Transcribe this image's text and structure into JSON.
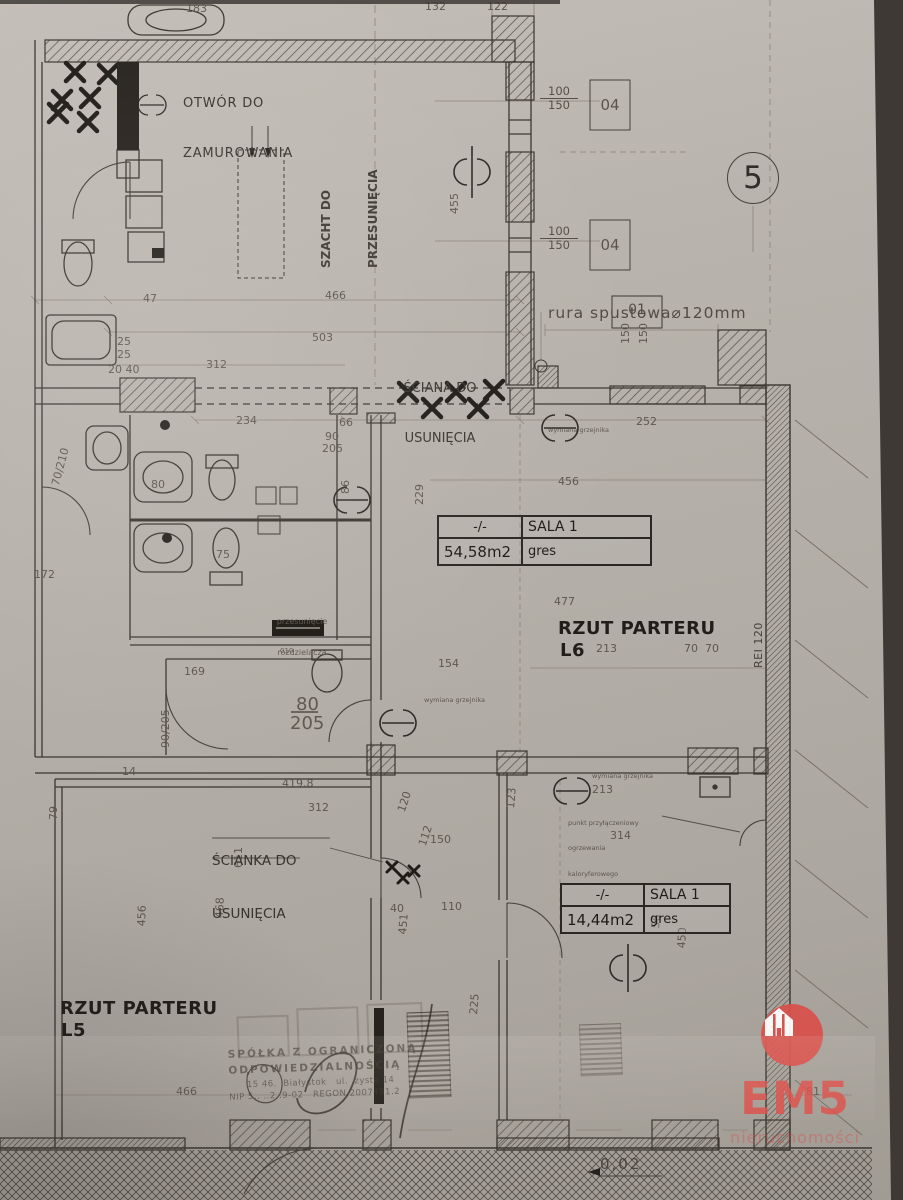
{
  "photo": {
    "backdrop_color": "#3e3935",
    "paper_color": "#b4afa8"
  },
  "plan": {
    "marker_number": "5",
    "titles": {
      "l6_line1": "RZUT PARTERU",
      "l6_line2": "L6",
      "l5_line1": "RZUT PARTERU",
      "l5_line2": "L5"
    },
    "annotations": {
      "otwor_line1": "OTWÓR DO",
      "otwor_line2": "ZAMUROWANIA",
      "szacht_line1": "SZACHT DO",
      "szacht_line2": "PRZESUNIĘCIA",
      "sciana_line1": "ŚCIANA DO",
      "sciana_line2": "USUNIĘCIA",
      "scianka_line1": "ŚCIANKA DO",
      "scianka_line2": "USUNIĘCIA",
      "rura": "rura spustowa⌀120mm",
      "rura_tag": "01",
      "rei": "REI 120",
      "slope": "0,02",
      "przesuniecie_line1": "przesunięcie",
      "przesuniecie_line2": "rozdzielacza",
      "punkt_line1": "punkt przyłączeniowy",
      "punkt_line2": "ogrzewania",
      "punkt_line3": "kaloryferowego",
      "note_grzejnik": "wymiana grzejnika"
    },
    "windows": {
      "w_top": "100",
      "w_bottom": "150",
      "tag": "04"
    },
    "tables": [
      {
        "cells": [
          [
            "-/-",
            "SALA 1"
          ],
          [
            "54,58m2",
            "gres"
          ]
        ]
      },
      {
        "cells": [
          [
            "-/-",
            "SALA 1"
          ],
          [
            "14,44m2",
            "gres"
          ]
        ]
      }
    ],
    "dim_labels": [
      {
        "t": "183",
        "x": 186,
        "y": 3
      },
      {
        "t": "132",
        "x": 425,
        "y": 1
      },
      {
        "t": "122",
        "x": 487,
        "y": 1
      },
      {
        "t": "455",
        "x": 449,
        "y": 214,
        "r": -90
      },
      {
        "t": "47",
        "x": 143,
        "y": 293
      },
      {
        "t": "466",
        "x": 325,
        "y": 290
      },
      {
        "t": "503",
        "x": 312,
        "y": 332
      },
      {
        "t": "312",
        "x": 206,
        "y": 359
      },
      {
        "t": "25",
        "x": 117,
        "y": 336
      },
      {
        "t": "25",
        "x": 117,
        "y": 349
      },
      {
        "t": "20 40",
        "x": 108,
        "y": 364
      },
      {
        "t": "234",
        "x": 236,
        "y": 415
      },
      {
        "t": "66",
        "x": 339,
        "y": 417
      },
      {
        "t": "252",
        "x": 636,
        "y": 416
      },
      {
        "t": "456",
        "x": 558,
        "y": 476
      },
      {
        "t": "229",
        "x": 414,
        "y": 505,
        "r": -90
      },
      {
        "t": "80",
        "x": 151,
        "y": 479
      },
      {
        "t": "75",
        "x": 216,
        "y": 549
      },
      {
        "t": "90",
        "x": 325,
        "y": 431
      },
      {
        "t": "205",
        "x": 322,
        "y": 443
      },
      {
        "t": "86",
        "x": 340,
        "y": 494,
        "r": -90
      },
      {
        "t": "477",
        "x": 554,
        "y": 596
      },
      {
        "t": "213",
        "x": 596,
        "y": 643
      },
      {
        "t": "70  70",
        "x": 684,
        "y": 643
      },
      {
        "t": "154",
        "x": 438,
        "y": 658
      },
      {
        "t": "169",
        "x": 184,
        "y": 666
      },
      {
        "t": "010",
        "x": 280,
        "y": 648,
        "s": 7
      },
      {
        "t": "80",
        "x": 296,
        "y": 696,
        "s": 18
      },
      {
        "t": "205",
        "x": 290,
        "y": 715,
        "s": 18
      },
      {
        "t": "90/205",
        "x": 160,
        "y": 748,
        "r": -90
      },
      {
        "t": "70/210",
        "x": 50,
        "y": 484,
        "r": -75
      },
      {
        "t": "172",
        "x": 34,
        "y": 569
      },
      {
        "t": "14",
        "x": 122,
        "y": 766
      },
      {
        "t": "419,8",
        "x": 282,
        "y": 778
      },
      {
        "t": "312",
        "x": 308,
        "y": 802
      },
      {
        "t": "120",
        "x": 396,
        "y": 810,
        "r": -72
      },
      {
        "t": "150",
        "x": 430,
        "y": 834
      },
      {
        "t": "112",
        "x": 417,
        "y": 844,
        "r": -72
      },
      {
        "t": "213",
        "x": 592,
        "y": 784
      },
      {
        "t": "314",
        "x": 610,
        "y": 830
      },
      {
        "t": "123",
        "x": 505,
        "y": 808,
        "r": -85
      },
      {
        "t": "611",
        "x": 233,
        "y": 868,
        "r": -90
      },
      {
        "t": "79",
        "x": 48,
        "y": 820,
        "r": -90
      },
      {
        "t": "40",
        "x": 390,
        "y": 903
      },
      {
        "t": "110",
        "x": 441,
        "y": 901
      },
      {
        "t": "451",
        "x": 397,
        "y": 934,
        "r": -85
      },
      {
        "t": "456",
        "x": 136,
        "y": 926,
        "r": -88
      },
      {
        "t": "468",
        "x": 214,
        "y": 918,
        "r": -88
      },
      {
        "t": "56",
        "x": 650,
        "y": 928,
        "r": -85
      },
      {
        "t": "450",
        "x": 676,
        "y": 948,
        "r": -87
      },
      {
        "t": "225",
        "x": 468,
        "y": 1014,
        "r": -85
      },
      {
        "t": "466",
        "x": 176,
        "y": 1086
      },
      {
        "t": "81",
        "x": 806,
        "y": 1086
      },
      {
        "t": "150",
        "x": 620,
        "y": 344,
        "r": -90
      },
      {
        "t": "150",
        "x": 638,
        "y": 344,
        "r": -90
      }
    ]
  },
  "stamp": {
    "line1": "SPÓŁKA Z OGRANICZONĄ",
    "line2": "ODPOWIEDZIALNOŚCIĄ",
    "line3": "15 46.  Białystok   ul. .zysta 14",
    "line4": "NIP 5.. ..2..9-02   REGON 2007481.2"
  },
  "logo": {
    "name": "EM5",
    "subtitle": "nieruchomości",
    "color": "#d9504b"
  }
}
